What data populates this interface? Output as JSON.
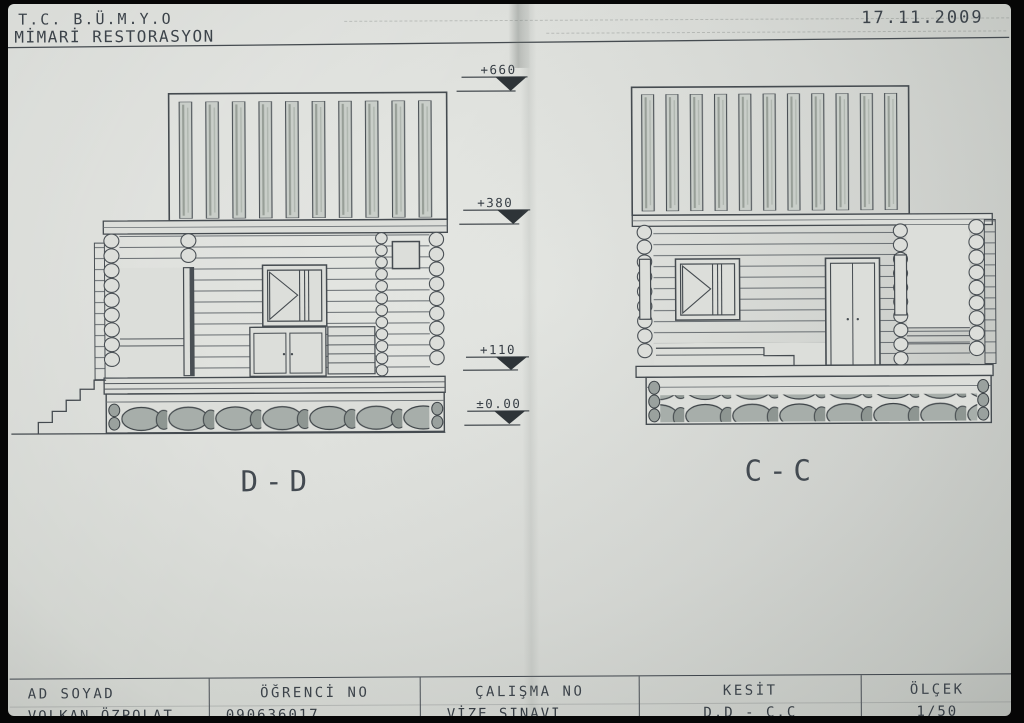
{
  "header": {
    "institution_line1": "T.C. B.Ü.M.Y.O",
    "institution_line2": "MİMARİ RESTORASYON",
    "date": "17.11.2009"
  },
  "drawings": {
    "left_section_label": "D-D",
    "right_section_label": "C-C"
  },
  "elevation_markers": [
    {
      "value": "+660"
    },
    {
      "value": "+380"
    },
    {
      "value": "+110"
    },
    {
      "value": "±0.00"
    }
  ],
  "title_block": {
    "columns": [
      {
        "label": "AD SOYAD",
        "value": "VOLKAN ÖZPOLAT"
      },
      {
        "label": "ÖĞRENCİ NO",
        "value": "090636017"
      },
      {
        "label": "ÇALIŞMA NO",
        "value": "VİZE SINAVI"
      },
      {
        "label": "KESİT",
        "value": "D.D - C.C"
      },
      {
        "label": "ÖLÇEK",
        "value": "1/50"
      }
    ]
  },
  "colors": {
    "paper": "#dcdeda",
    "ink": "#454b50",
    "ink_dark": "#2e3438",
    "plank_shade": "#c9cec9",
    "stone_fill": "#a7aeaa",
    "frame": "#060606"
  }
}
